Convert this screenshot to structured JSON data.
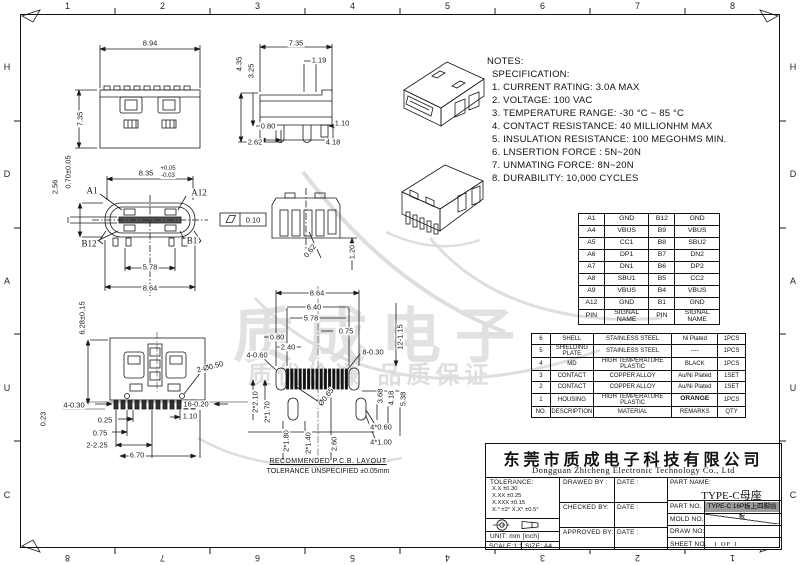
{
  "border": {
    "top_numbers": [
      "1",
      "2",
      "3",
      "4",
      "5",
      "6",
      "7",
      "8"
    ],
    "bottom_numbers": [
      "8",
      "7",
      "6",
      "5",
      "4",
      "3",
      "2",
      "1"
    ],
    "left_letters": [
      "H",
      "D",
      "A",
      "U",
      "C"
    ],
    "right_letters": [
      "H",
      "D",
      "A",
      "U",
      "C"
    ]
  },
  "watermark": {
    "main": "质成电子",
    "sub": "质优价谦 品质保证"
  },
  "notes": {
    "title": "NOTES:",
    "lines": [
      "SPECIFICATION:",
      "1. CURRENT RATING: 3.0A MAX",
      "2. VOLTAGE: 100 VAC",
      "3. TEMPERATURE RANGE: -30 °C ~ 85 °C",
      "4. CONTACT RESISTANCE: 40 MILLIONHM MAX",
      "5. INSULATION RESISTANCE: 100 MEGOHMS MIN.",
      "6. LNSERTION FORCE : 5N~20N",
      "7. UNMATING FORCE: 8N~20N",
      "8. DURABILITY:  10,000 CYCLES"
    ]
  },
  "pin_table": {
    "rows": [
      [
        "A1",
        "GND",
        "B12",
        "GND"
      ],
      [
        "A4",
        "VBUS",
        "B9",
        "VBUS"
      ],
      [
        "A5",
        "CC1",
        "B8",
        "SBU2"
      ],
      [
        "A6",
        "DP1",
        "B7",
        "DN2"
      ],
      [
        "A7",
        "DN1",
        "B6",
        "DP2"
      ],
      [
        "A8",
        "SBU1",
        "B5",
        "CC2"
      ],
      [
        "A9",
        "VBUS",
        "B4",
        "VBUS"
      ],
      [
        "A12",
        "GND",
        "B1",
        "GND"
      ],
      [
        "PIN",
        "SIGNAL NAME",
        "PIN",
        "SIGNAL NAME"
      ]
    ]
  },
  "bom_table": {
    "rows": [
      [
        "6",
        "SHELL",
        "STAINLESS STEEL",
        "Ni Plated",
        "1PCS"
      ],
      [
        "5",
        "SHIELDING PLATE",
        "STAINLESS STEEL",
        "----",
        "1PCS"
      ],
      [
        "4",
        "MD",
        "HIGH TEMPERATURE PLASTIC",
        "BLACK",
        "1PCS"
      ],
      [
        "3",
        "CONTACT",
        "COPPER ALLOY",
        "Au/Ni Plated",
        "1SET"
      ],
      [
        "2",
        "CONTACT",
        "COPPER ALLOY",
        "Au/Ni Plated",
        "1SET"
      ],
      [
        "1",
        "HOUSING",
        "HIGH TEMPERATURE PLASTIC",
        "ORANGE",
        "1PCS"
      ],
      [
        "NO.",
        "DESCRIPTION",
        "MATERIAL",
        "REMARKS",
        "QTY"
      ]
    ]
  },
  "dims": {
    "top_view": [
      {
        "t": "8.94",
        "x": 150,
        "y": 43
      },
      {
        "t": "7.35",
        "x": 80,
        "y": 119,
        "r": -90
      }
    ],
    "side_view": [
      {
        "t": "7.35",
        "x": 296,
        "y": 43
      },
      {
        "t": "1.19",
        "x": 319,
        "y": 60
      },
      {
        "t": "4.35",
        "x": 239,
        "y": 64,
        "r": -90
      },
      {
        "t": "3.25",
        "x": 251,
        "y": 71,
        "r": -90
      },
      {
        "t": "0.80",
        "x": 268,
        "y": 126
      },
      {
        "t": "1.10",
        "x": 342,
        "y": 123
      },
      {
        "t": "2.62",
        "x": 255,
        "y": 142
      },
      {
        "t": "4.18",
        "x": 333,
        "y": 142
      }
    ],
    "front_view": [
      {
        "t": "A1",
        "x": 92,
        "y": 191,
        "c": "serif"
      },
      {
        "t": "A12",
        "x": 199,
        "y": 193,
        "c": "serif"
      },
      {
        "t": "B12",
        "x": 89,
        "y": 244,
        "c": "serif"
      },
      {
        "t": "B1",
        "x": 192,
        "y": 241,
        "c": "serif"
      },
      {
        "t": "8.35",
        "x": 146,
        "y": 173
      },
      {
        "t": "+0.05",
        "x": 168,
        "y": 169,
        "s": 6
      },
      {
        "t": "-0.03",
        "x": 168,
        "y": 176,
        "s": 6
      },
      {
        "t": "2.56",
        "x": 55,
        "y": 187,
        "r": -90
      },
      {
        "t": "0.70±0.05",
        "x": 68,
        "y": 172,
        "r": -90
      },
      {
        "t": "5.78",
        "x": 150,
        "y": 267
      },
      {
        "t": "8.64",
        "x": 150,
        "y": 288
      }
    ],
    "section": [
      {
        "t": "0.10",
        "x": 253,
        "y": 220
      },
      {
        "t": "0.62",
        "x": 310,
        "y": 251,
        "r": -52
      },
      {
        "t": "1.20",
        "x": 352,
        "y": 252,
        "r": -90
      }
    ],
    "bottom_view": [
      {
        "t": "6.28±0.15",
        "x": 82,
        "y": 318,
        "r": -90
      },
      {
        "t": "2-Ø0.50",
        "x": 210,
        "y": 367,
        "r": -14
      },
      {
        "t": "4-0.30",
        "x": 74,
        "y": 405
      },
      {
        "t": "16-0.20",
        "x": 196,
        "y": 404
      },
      {
        "t": "1.10",
        "x": 190,
        "y": 416
      },
      {
        "t": "0.25",
        "x": 105,
        "y": 420
      },
      {
        "t": "0.75",
        "x": 100,
        "y": 433
      },
      {
        "t": "2-2.25",
        "x": 97,
        "y": 445
      },
      {
        "t": "6.70",
        "x": 137,
        "y": 455
      },
      {
        "t": "0.23",
        "x": 43,
        "y": 419,
        "r": -90
      }
    ],
    "pcb_view": [
      {
        "t": "8.64",
        "x": 317,
        "y": 293
      },
      {
        "t": "6.40",
        "x": 314,
        "y": 307
      },
      {
        "t": "5.78",
        "x": 311,
        "y": 318
      },
      {
        "t": "0.75",
        "x": 346,
        "y": 331
      },
      {
        "t": "0.80",
        "x": 277,
        "y": 337
      },
      {
        "t": "2.40",
        "x": 288,
        "y": 347
      },
      {
        "t": "4-0.60",
        "x": 257,
        "y": 355
      },
      {
        "t": "8-0.30",
        "x": 373,
        "y": 352
      },
      {
        "t": "12-1.15",
        "x": 400,
        "y": 337,
        "r": -90
      },
      {
        "t": "Ø0.65",
        "x": 326,
        "y": 397,
        "r": -52
      },
      {
        "t": "2*2.10",
        "x": 255,
        "y": 402,
        "r": -90
      },
      {
        "t": "2*1.70",
        "x": 267,
        "y": 412,
        "r": -90
      },
      {
        "t": "3.68",
        "x": 380,
        "y": 396,
        "r": -90
      },
      {
        "t": "4.18",
        "x": 391,
        "y": 398,
        "r": -90
      },
      {
        "t": "5.38",
        "x": 403,
        "y": 399,
        "r": -90
      },
      {
        "t": "2*1.80",
        "x": 286,
        "y": 441,
        "r": -90
      },
      {
        "t": "2*1.40",
        "x": 308,
        "y": 443,
        "r": -90
      },
      {
        "t": "2.60",
        "x": 334,
        "y": 444,
        "r": -90
      },
      {
        "t": "4*0.60",
        "x": 381,
        "y": 427
      },
      {
        "t": "4*1.00",
        "x": 381,
        "y": 442
      }
    ]
  },
  "pcb_captions": {
    "line1": "RECOMMENDED   P.C.B.  LAYOUT",
    "line2": "TOLERANCE UNSPECIFIED ±0.05mm"
  },
  "title_block": {
    "company_cn": "东莞市质成电子科技有限公司",
    "company_en": "Dongguan Zhicheng Electronic Technology Co., Ltd",
    "tolerance_title": "TOLERANCE:",
    "tolerance_lines": [
      "X.X    ±0.30",
      "X.XX   ±0.25",
      "X.XXX  ±0.15",
      "X.°  ±2°      X.X°  ±0.5°"
    ],
    "unit": "UNIT:  mm  [inch]",
    "scale": "SCALE:1:1",
    "size": "SIZE:  A4",
    "drawed_by": "DRAWED  BY :",
    "checked_by": "CHECKED  BY:",
    "approved_by": "APPROVED  BY:",
    "date": "DATE :",
    "part_name_label": "PART  NAME:",
    "part_name": "TYPE-C母座",
    "part_no_label": "PART  NO.",
    "part_no": "TYPE-C 16P板上四脚插板",
    "mold_no_label": "MOLD  NO.",
    "draw_no_label": "DRAW  NO:",
    "sheet_no_label": "SHEET  NO.",
    "sheet_no": "1 OF 1"
  }
}
